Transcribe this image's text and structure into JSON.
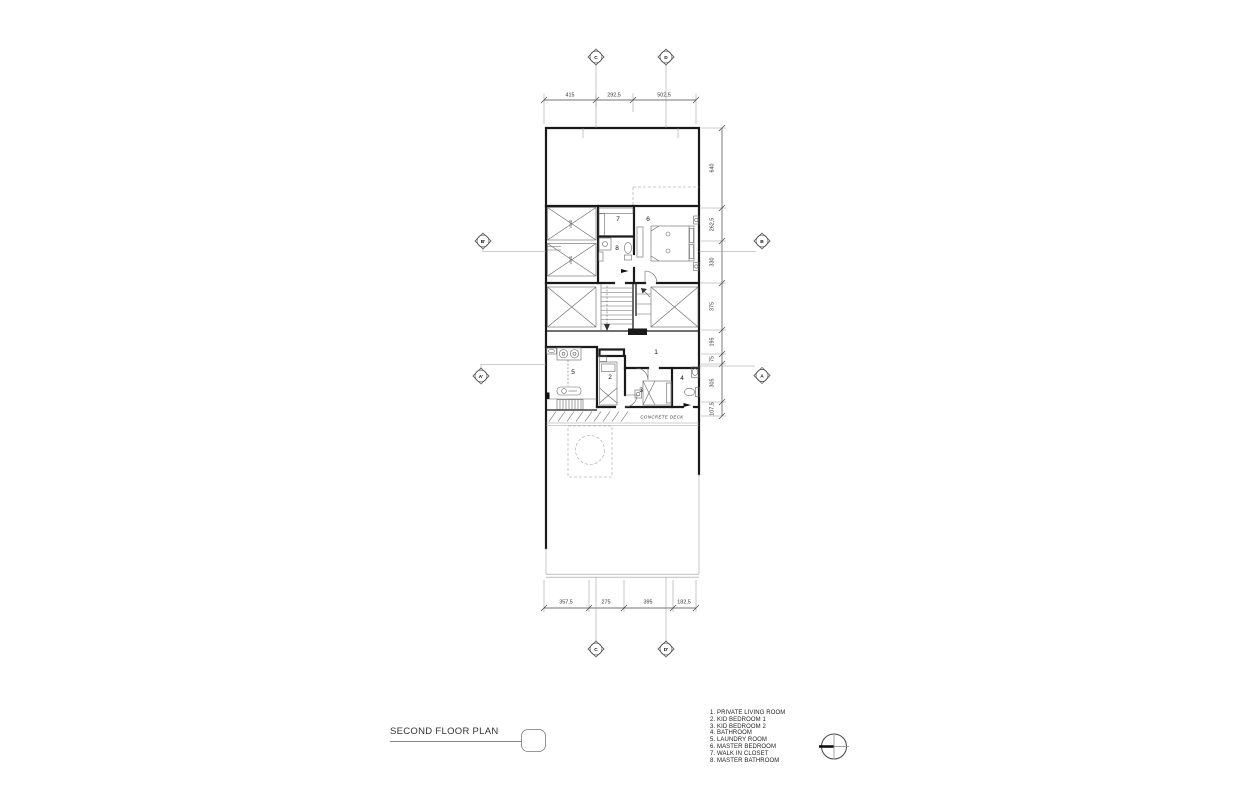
{
  "drawing": {
    "title": "SECOND FLOOR PLAN",
    "deck_label": "CONCRETE DECK",
    "void_label": "VOID"
  },
  "legend": {
    "items": [
      "1. PRIVATE LIVING ROOM",
      "2. KID BEDROOM 1",
      "3. KID BEDROOM 2",
      "4. BATHROOM",
      "5. LAUNDRY ROOM",
      "6. MASTER BEDROOM",
      "7. WALK IN CLOSET",
      "8. MASTER BATHROOM"
    ]
  },
  "grid_markers": {
    "top": [
      "C",
      "D"
    ],
    "bottom": [
      "C",
      "D'"
    ],
    "left": [
      "B'",
      "A'"
    ],
    "right": [
      "B",
      "A"
    ]
  },
  "dimensions": {
    "top": [
      "415",
      "292,5",
      "502,5"
    ],
    "bottom": [
      "357,5",
      "275",
      "395",
      "182,5"
    ],
    "right": [
      "640",
      "262,5",
      "330",
      "375",
      "195",
      "75",
      "305",
      "107,5"
    ]
  },
  "room_numbers": {
    "private_living_room": "1",
    "kid_bedroom_1": "2",
    "kid_bedroom_2": "3",
    "bathroom": "4",
    "laundry_room": "5",
    "master_bedroom": "6",
    "walk_in_closet": "7",
    "master_bathroom": "8"
  }
}
